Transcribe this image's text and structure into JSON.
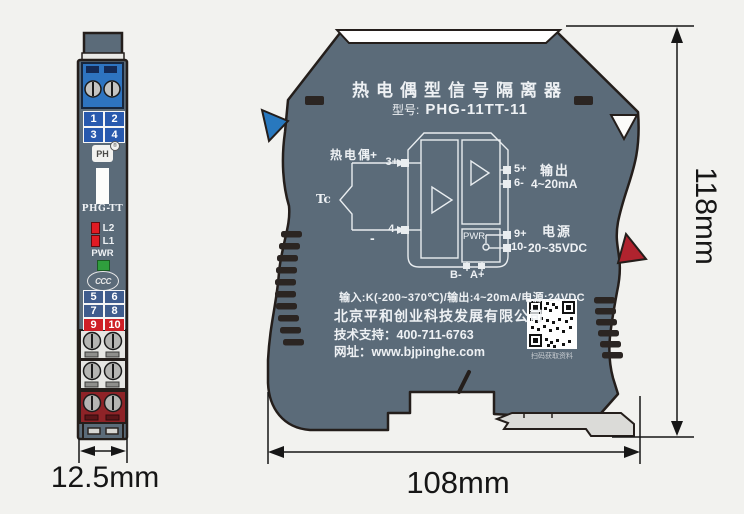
{
  "colors": {
    "body": "#5b6b79",
    "outline": "#241e1b",
    "clip_blue": "#2878be",
    "clip_red": "#b0232e",
    "terminal_blue": "#2e74c0",
    "grid_blue": "#2859ae",
    "grid_red": "#cf1f26",
    "led_red": "#e01b24",
    "led_green": "#2f9e3d",
    "terminal_dark_red": "#8e2327"
  },
  "side_view": {
    "top_numbers": [
      "1",
      "2",
      "3",
      "4"
    ],
    "logo": "PH",
    "logo_reg": "®",
    "model": "PHG-TT",
    "led2": "L2",
    "led1": "L1",
    "pwr": "PWR",
    "cert": "CCC",
    "bottom_numbers": [
      "5",
      "6",
      "7",
      "8",
      "9",
      "10"
    ],
    "width_dim": "12.5mm"
  },
  "front_view": {
    "title": "热电偶型信号隔离器",
    "model_label": "型号:",
    "model_value": "PHG-11TT-11",
    "diagram": {
      "sensor_label": "热电偶",
      "tc": "Tc",
      "plus": "+",
      "minus": "-",
      "t_in_plus": "3+",
      "t_in_minus": "4-",
      "t_out_plus": "5+",
      "t_out_minus": "6-",
      "t_pwr_plus": "9+",
      "t_pwr_minus": "10-",
      "output_label": "输出",
      "output_range": "4~20mA",
      "power_label": "电源",
      "power_range": "20~35VDC",
      "pwr": "PWR",
      "bus_b": "B-",
      "bus_a": "A+"
    },
    "spec_line": "输入:K(-200~370℃)/输出:4~20mA/电源:24VDC",
    "company": "北京平和创业科技发展有限公司",
    "support": "技术支持：400-711-6763",
    "website": "网址：www.bjpinghe.com",
    "qr_caption": "扫码获取资料",
    "height_dim": "118mm",
    "width_dim": "108mm"
  }
}
